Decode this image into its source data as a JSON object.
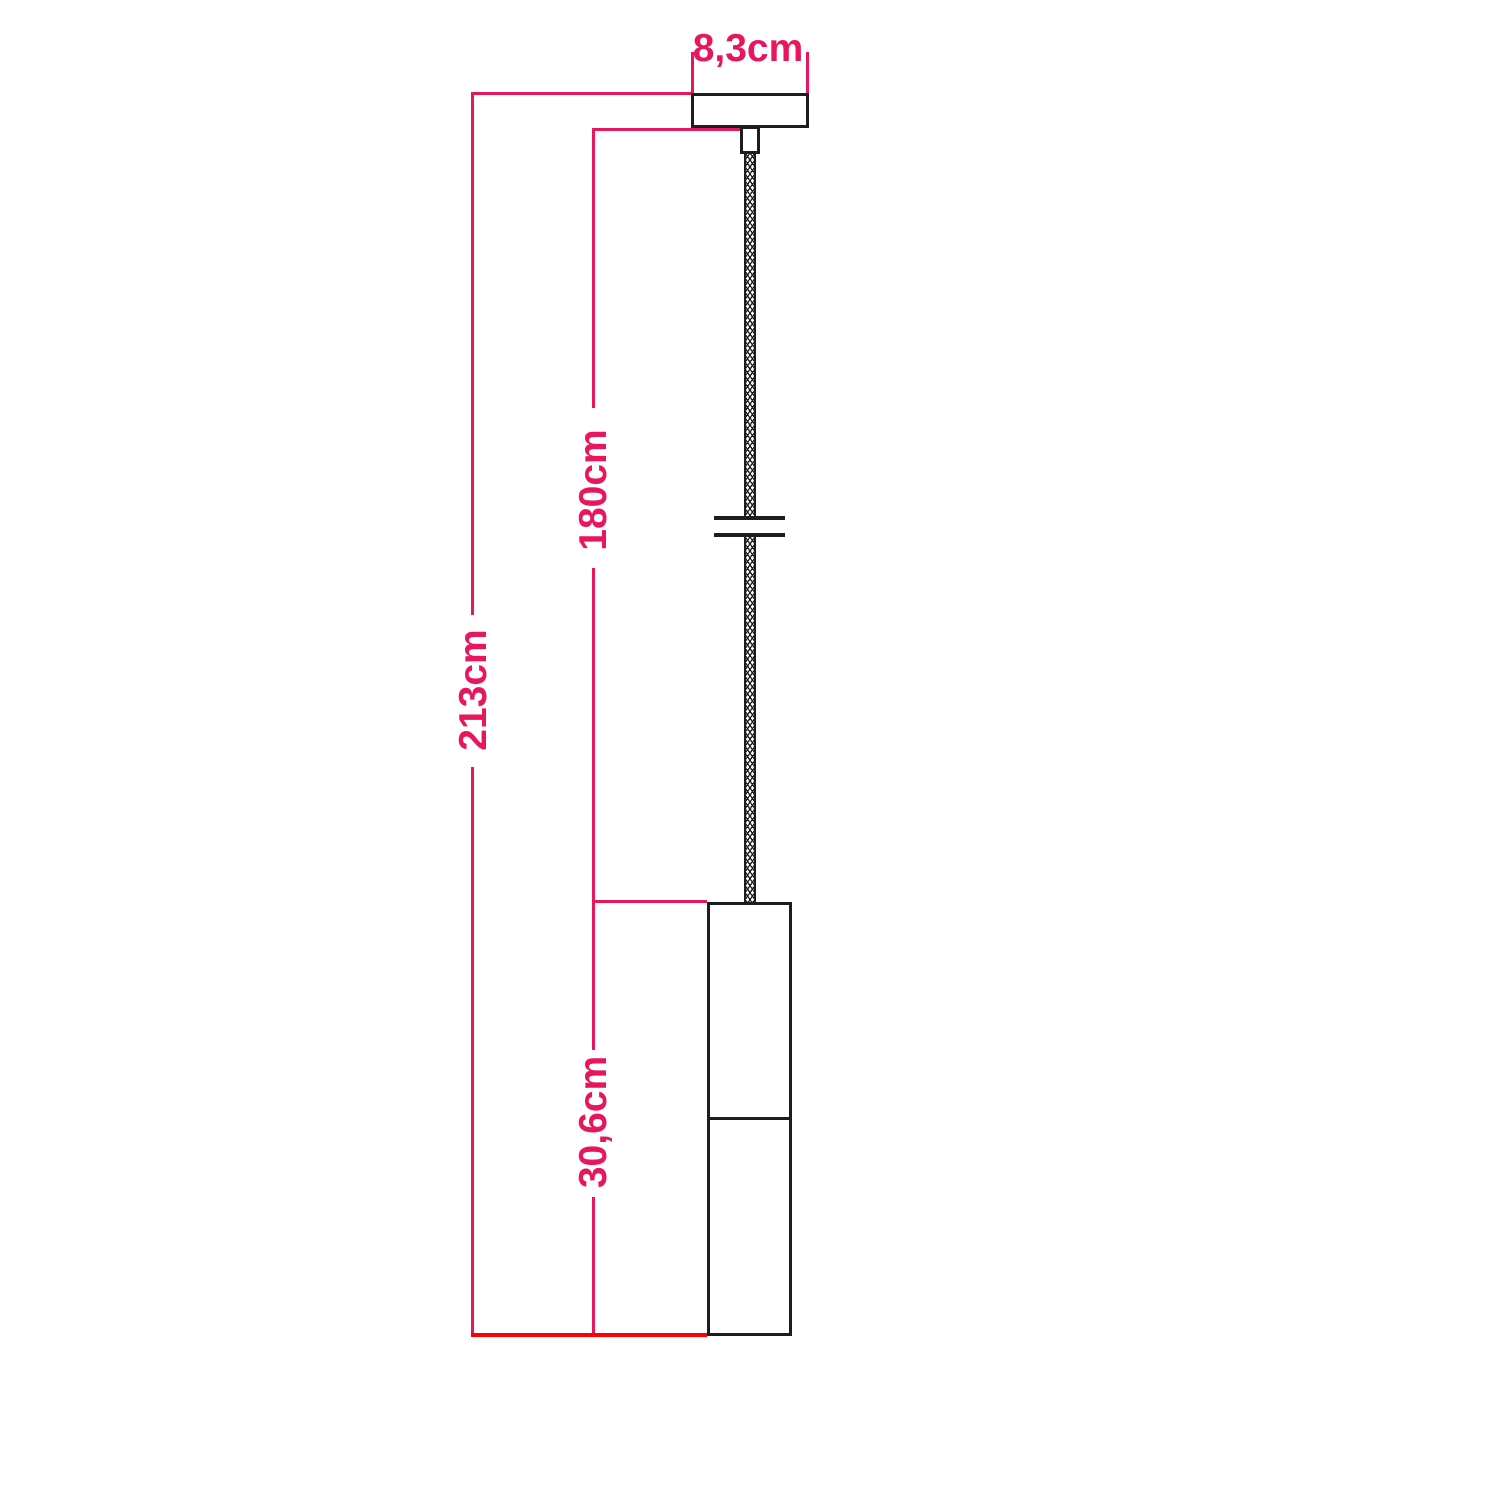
{
  "labels": {
    "canopy_width": "8,3cm",
    "cable_length": "180cm",
    "total_height": "213cm",
    "lamp_height": "30,6cm"
  },
  "colors": {
    "dimension_pink": "#e8175d",
    "baseline_red": "#ff0000",
    "outline_black": "#1d1d1b",
    "background": "#ffffff"
  }
}
